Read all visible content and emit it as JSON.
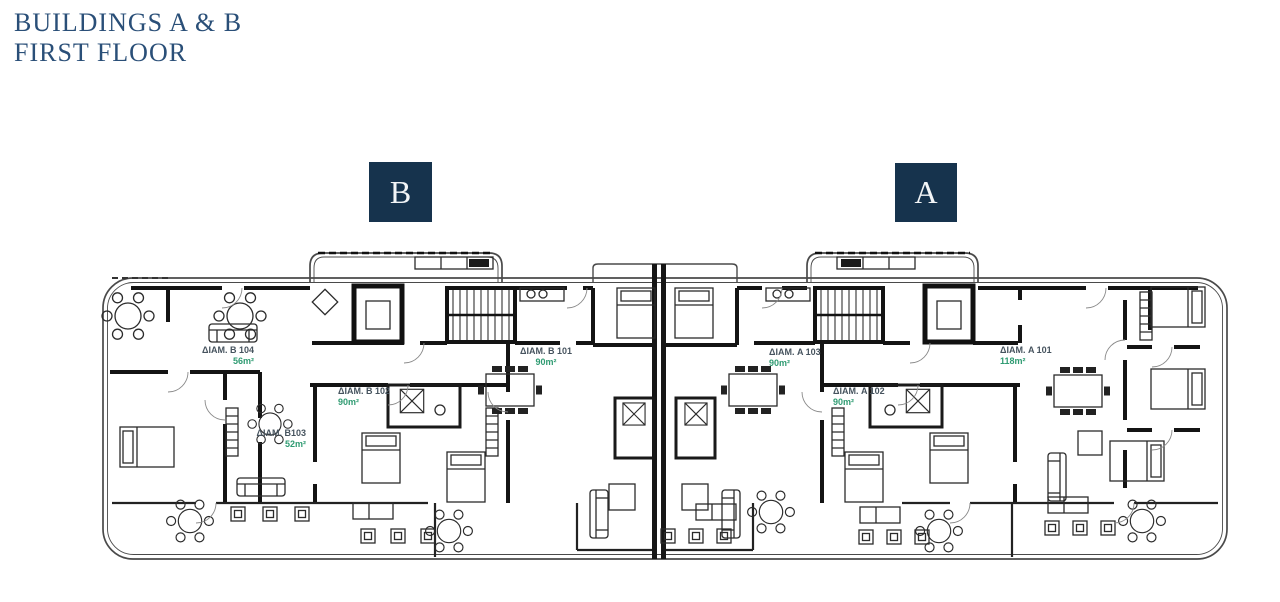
{
  "title": {
    "line1": "BUILDINGS A & B",
    "line2": "FIRST FLOOR"
  },
  "building_markers": [
    {
      "label": "B",
      "x": 369,
      "y": 162,
      "w": 63,
      "h": 60
    },
    {
      "label": "A",
      "x": 895,
      "y": 163,
      "w": 62,
      "h": 59
    }
  ],
  "apartments": [
    {
      "id": "B104",
      "name": "ΔΙΑΜ. B 104",
      "area": "56m²",
      "x": 196,
      "y": 345,
      "w": 58,
      "align": "right"
    },
    {
      "id": "B103",
      "name": "ΔΙΑΜ. B103",
      "area": "52m²",
      "x": 249,
      "y": 428,
      "w": 57,
      "align": "right"
    },
    {
      "id": "B102",
      "name": "ΔΙΑΜ. B 102",
      "area": "90m²",
      "x": 338,
      "y": 386,
      "w": 55,
      "align": "left"
    },
    {
      "id": "B101",
      "name": "ΔΙΑΜ. B 101",
      "area": "90m²",
      "x": 516,
      "y": 346,
      "w": 60,
      "align": "center"
    },
    {
      "id": "A103",
      "name": "ΔΙΑΜ. A 103",
      "area": "90m²",
      "x": 769,
      "y": 347,
      "w": 60,
      "align": "left"
    },
    {
      "id": "A102",
      "name": "ΔΙΑΜ. A 102",
      "area": "90m²",
      "x": 833,
      "y": 386,
      "w": 55,
      "align": "left"
    },
    {
      "id": "A101",
      "name": "ΔΙΑΜ. A 101",
      "area": "118m²",
      "x": 1000,
      "y": 345,
      "w": 62,
      "align": "left"
    }
  ],
  "colors": {
    "title": "#2a4f78",
    "marker_bg": "#16334d",
    "marker_fg": "#f2f5f7",
    "apartment_name": "#46535e",
    "apartment_area": "#2f9b72",
    "plan_line": "#1c1c1c"
  }
}
